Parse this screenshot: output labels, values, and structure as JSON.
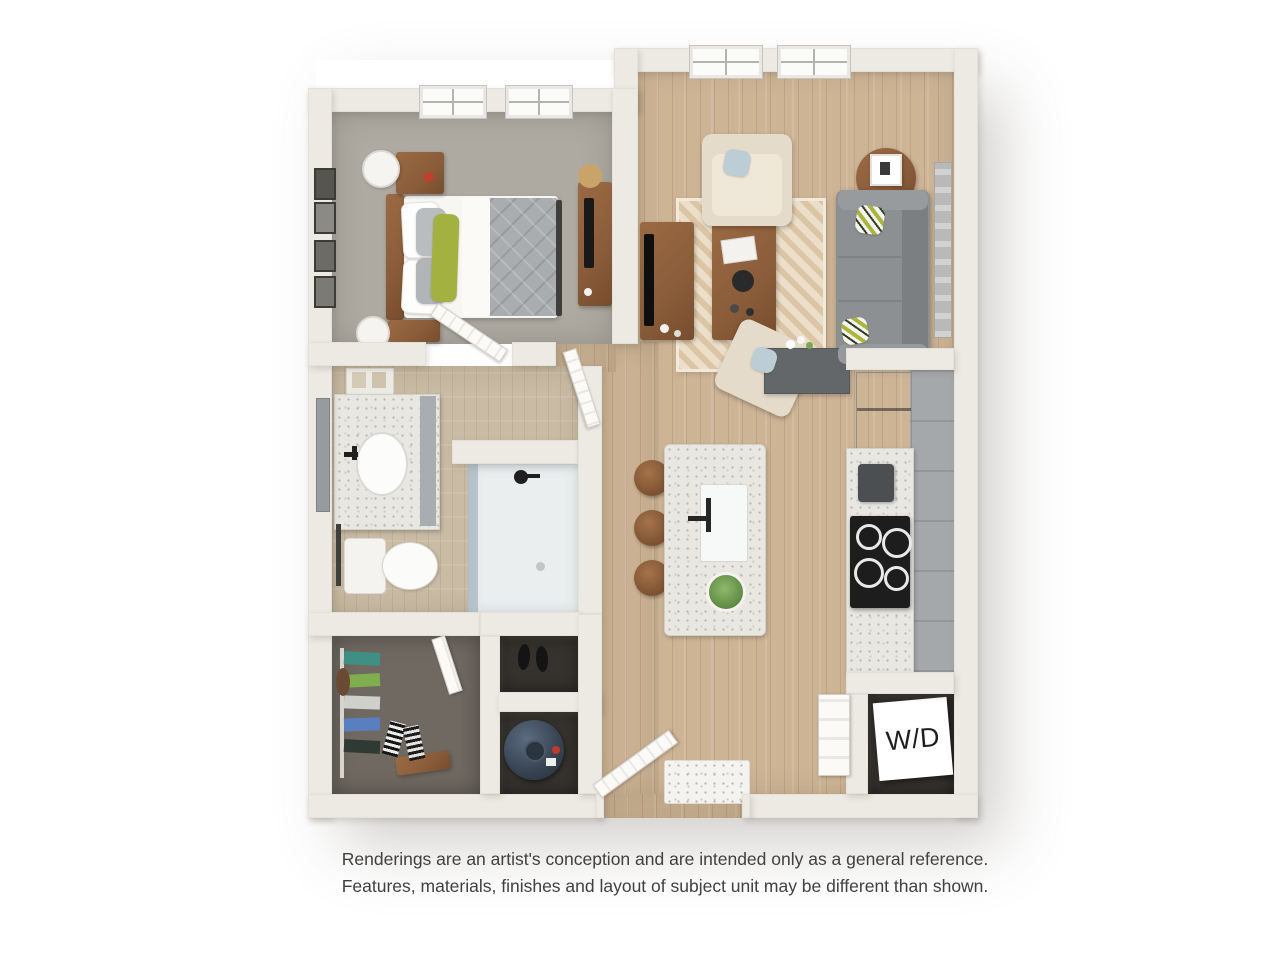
{
  "floorplan": {
    "wd_label": "W/D"
  },
  "disclaimer": {
    "line1": "Renderings are an artist's conception and are intended only as a general reference.",
    "line2": "Features, materials, finishes and layout of subject unit may be different than shown."
  },
  "colors": {
    "wall": "#edeae3",
    "wood_floor": "#cdb495",
    "bathroom_floor": "#c9bba4",
    "bedroom_carpet": "#aeaaa2",
    "closet_carpet": "#6f6961",
    "dark_floor": "#36332f",
    "sofa_gray": "#8d9092",
    "armchair_beige": "#e5dbca",
    "pillow_green": "#a2b13f",
    "rug_light": "#ecdfca",
    "rug_beige": "#dcc5a5",
    "wood_furniture": "#8a5c39",
    "comforter_gray": "#aaadaf",
    "counter_speckle": "#e9e7e1",
    "counter_dark": "#63676a",
    "cabinet_gray": "#a4a8ab",
    "cooktop_black": "#1d1d1d",
    "fridge_steel": "#b7babd",
    "heater_navy": "#3a4654",
    "art_gray": "#b9bab8",
    "wd_text": "#1e1e1e",
    "disclaimer_text": "#404040"
  }
}
